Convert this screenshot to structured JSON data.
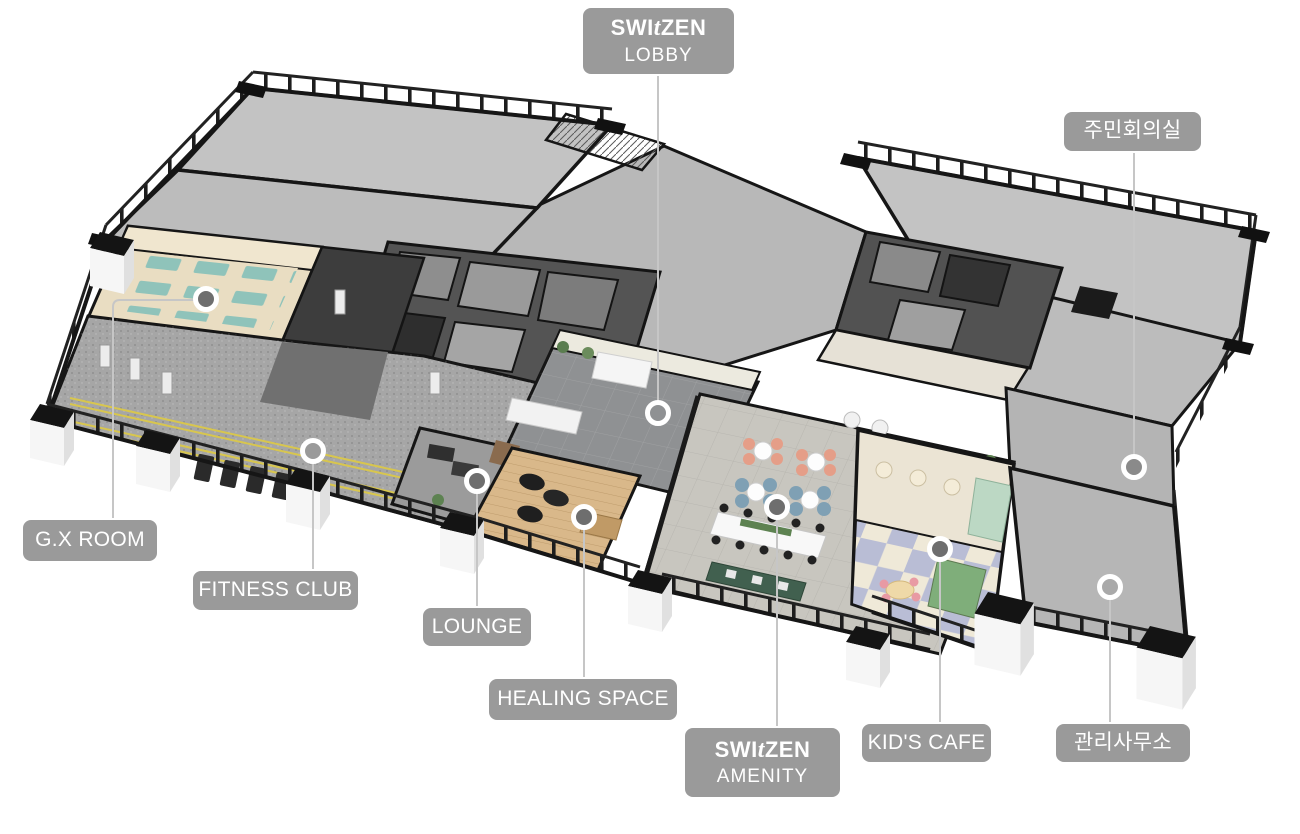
{
  "page": {
    "type": "isometric-3d-floorplan-render",
    "background": "#ffffff",
    "description_visible_rooms": [
      "lobby",
      "gx room",
      "fitness club",
      "lounge",
      "healing space",
      "amenity hall",
      "kids cafe",
      "management office",
      "residents meeting room"
    ]
  },
  "brand": {
    "logo_part1": "SWI",
    "logo_italic": "t",
    "logo_part2": "ZEN"
  },
  "labels": [
    {
      "id": "lobby",
      "brand": true,
      "text": "LOBBY"
    },
    {
      "id": "residents-meeting-room",
      "brand": false,
      "text": "주민회의실"
    },
    {
      "id": "gx-room",
      "brand": false,
      "text": "G.X ROOM"
    },
    {
      "id": "fitness-club",
      "brand": false,
      "text": "FITNESS CLUB"
    },
    {
      "id": "lounge",
      "brand": false,
      "text": "LOUNGE"
    },
    {
      "id": "healing-space",
      "brand": false,
      "text": "HEALING SPACE"
    },
    {
      "id": "amenity",
      "brand": true,
      "text": "AMENITY"
    },
    {
      "id": "kids-cafe",
      "brand": false,
      "text": "KID'S CAFE"
    },
    {
      "id": "management-office",
      "brand": false,
      "text": "관리사무소"
    }
  ],
  "colors": {
    "label_bg": "#9a9a9a",
    "label_text": "#ffffff",
    "leader_line": "#c6c6c6",
    "marker_ring": "#ffffff",
    "marker_fill_dark": "#6e6e6e",
    "floor_gray": "#bcbcbc",
    "wall_black": "#161616",
    "track_yellow": "#d8c64e",
    "gx_mat_teal": "#8fc3ba",
    "healing_wood": "#d9b88a",
    "kids_checker_a": "#b9bdd5",
    "kids_checker_b": "#efe9d8",
    "amenity_chair_salmon": "#e59e88",
    "amenity_chair_blue": "#7fa0b4",
    "bench_green": "#41604f"
  }
}
